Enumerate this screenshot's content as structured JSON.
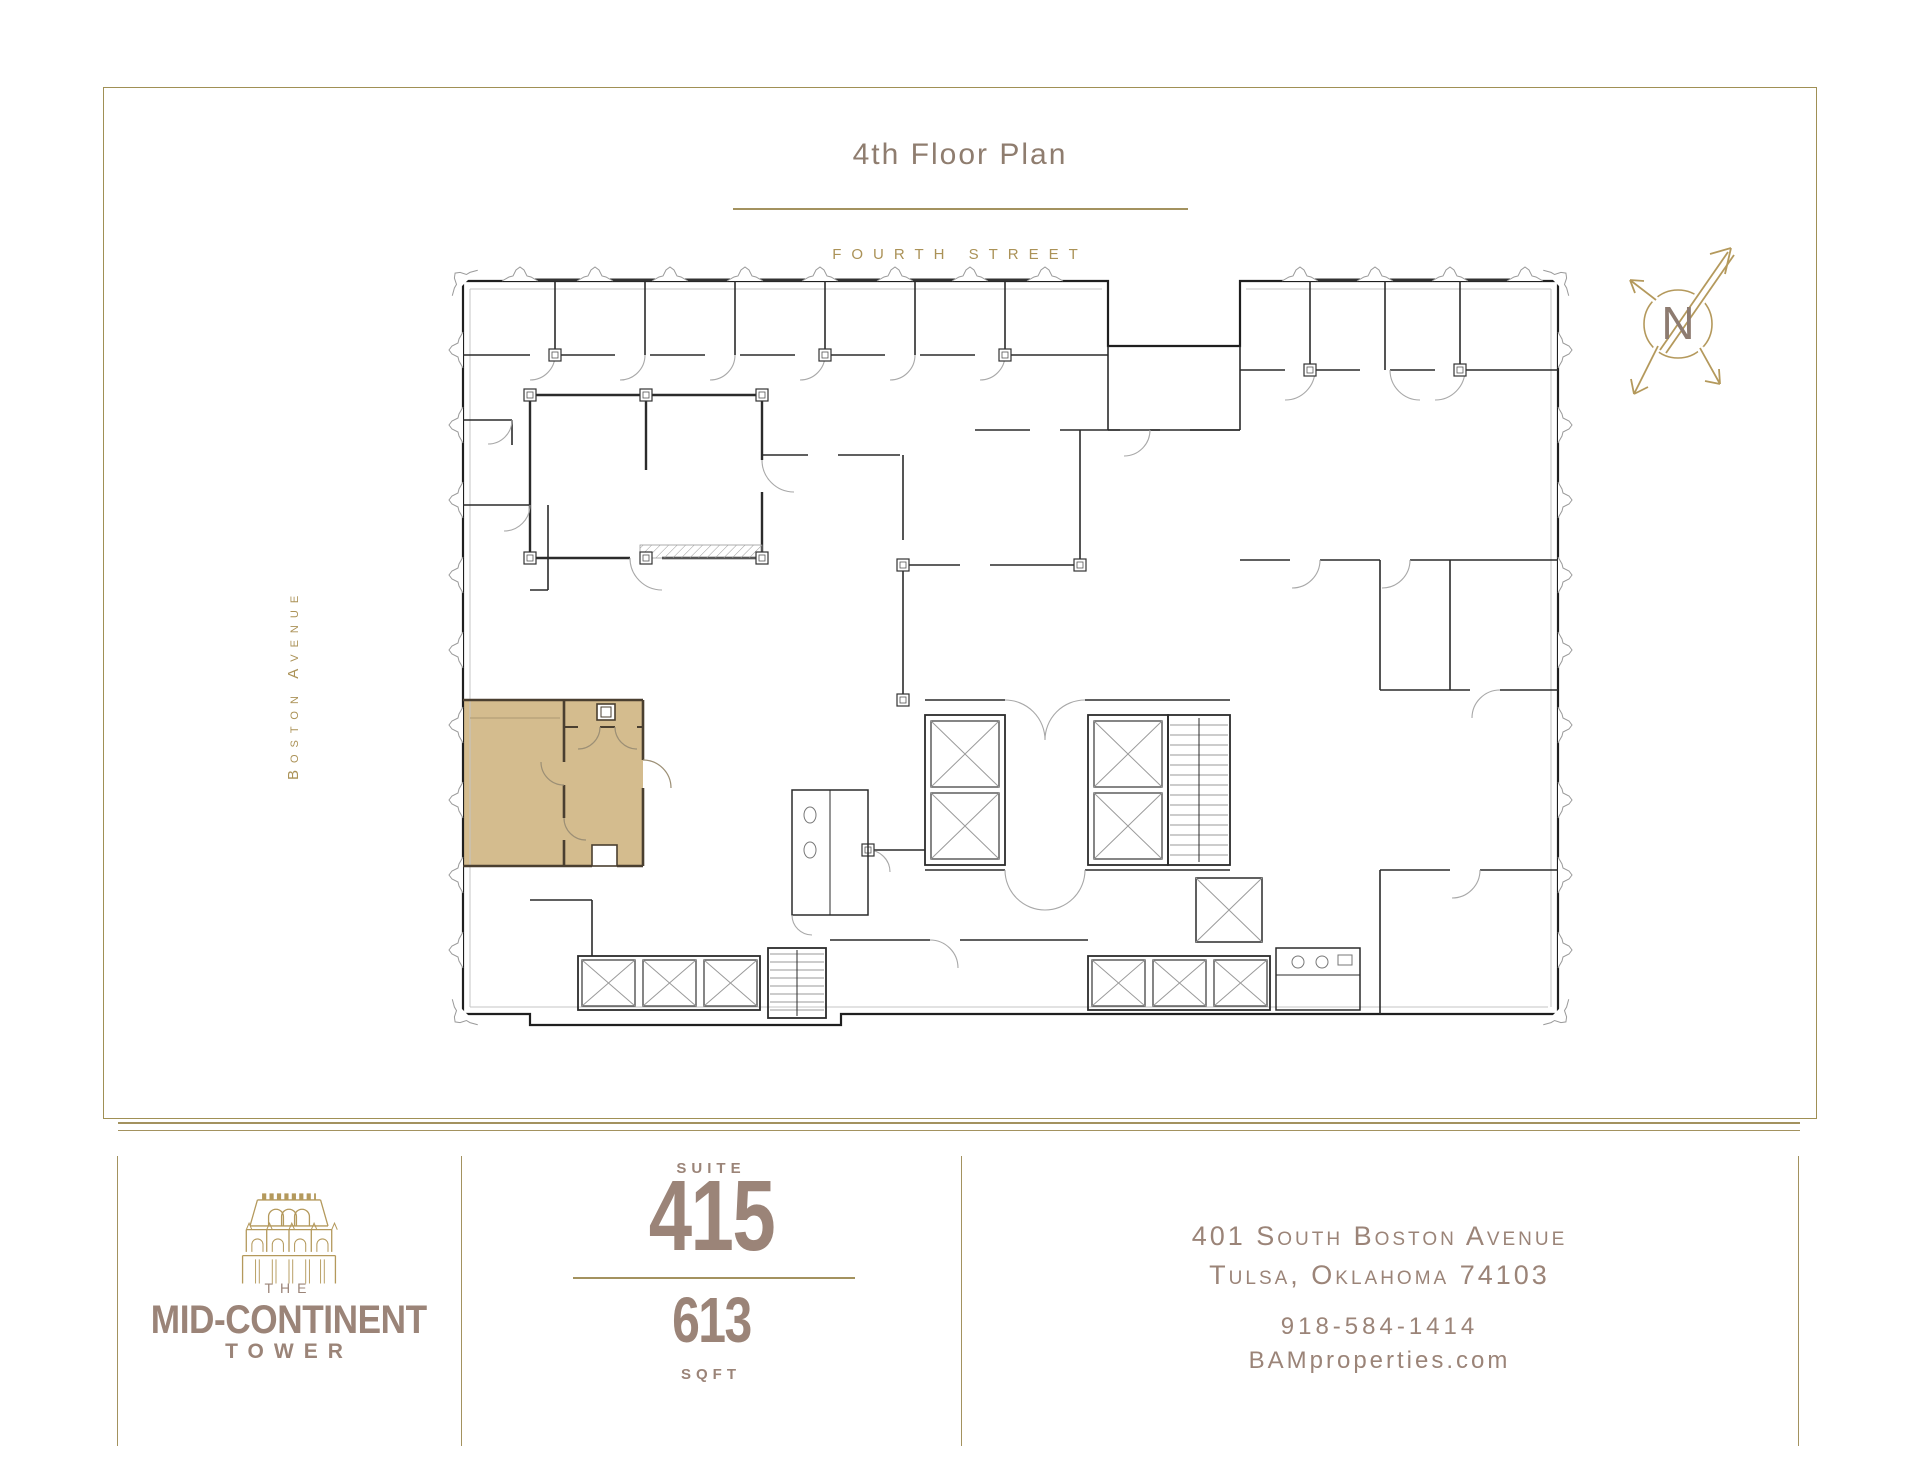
{
  "page": {
    "title": "4th Floor Plan"
  },
  "plan": {
    "heading": "4th Floor Plan",
    "street_top": "FOURTH STREET",
    "street_left": "Boston Avenue",
    "compass_north": "N",
    "highlighted_suite": "Suite 415"
  },
  "footer": {
    "logo": {
      "the": "THE",
      "name": "MID-CONTINENT",
      "tower": "TOWER"
    },
    "suite": {
      "label": "SUITE",
      "number": "415"
    },
    "area": {
      "value": "613",
      "label": "SQFT"
    },
    "contact": {
      "address_line1": "401 South Boston Avenue",
      "address_line2": "Tulsa, Oklahoma 74103",
      "phone": "918-584-1414",
      "website": "BAMproperties.com"
    }
  },
  "colors": {
    "gold": "#a3925f",
    "gold_text": "#ab9257",
    "taupe": "#9b8478",
    "title_taupe": "#8f7d6f",
    "suite_highlight": "#d4bc8e",
    "logo_gold": "#b4995c",
    "compass_n": "#8d7b70",
    "wall": "#262626"
  }
}
